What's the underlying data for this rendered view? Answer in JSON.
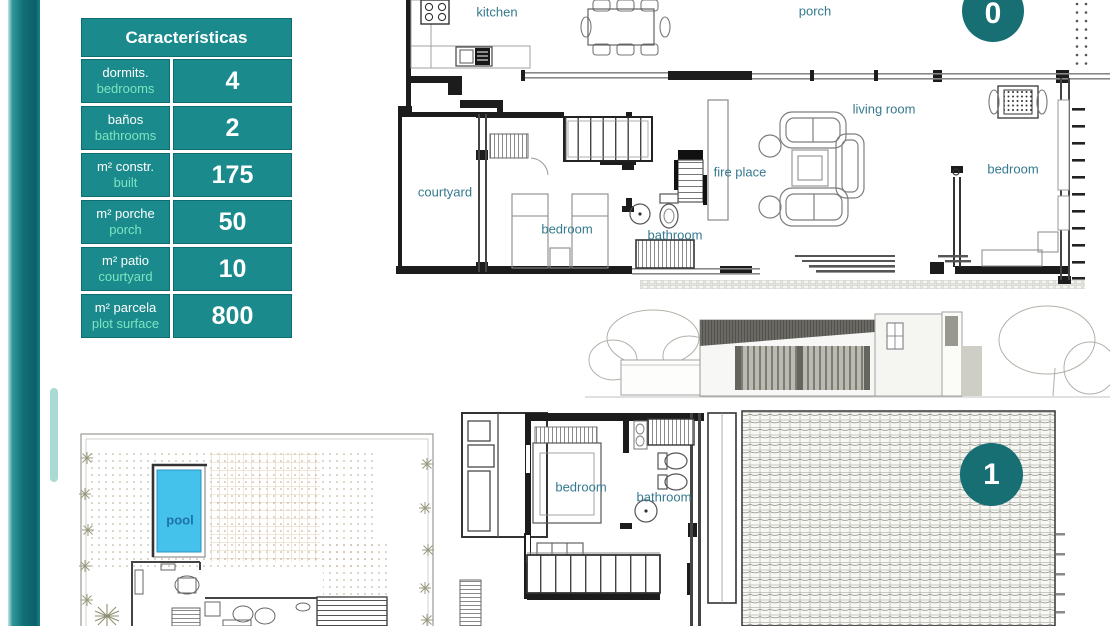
{
  "table": {
    "title": "Características",
    "rows": [
      {
        "label_es": "dormits.",
        "label_en": "bedrooms",
        "value": "4"
      },
      {
        "label_es": "baños",
        "label_en": "bathrooms",
        "value": "2"
      },
      {
        "label_es": "m² constr.",
        "label_en": "built",
        "value": "175"
      },
      {
        "label_es": "m² porche",
        "label_en": "porch",
        "value": "50"
      },
      {
        "label_es": "m² patio",
        "label_en": "courtyard",
        "value": "10"
      },
      {
        "label_es": "m² parcela",
        "label_en": "plot surface",
        "value": "800"
      }
    ]
  },
  "floor0": {
    "badge": "0",
    "labels": {
      "kitchen": "kitchen",
      "porch": "porch",
      "living_room": "living room",
      "fire_place": "fire place",
      "bedroom_right": "bedroom",
      "courtyard": "courtyard",
      "bedroom_center": "bedroom",
      "bathroom": "bathroom"
    }
  },
  "floor1": {
    "badge": "1",
    "labels": {
      "bedroom": "bedroom",
      "bathroom": "bathroom"
    }
  },
  "site_plan": {
    "labels": {
      "pool": "pool"
    }
  },
  "colors": {
    "table_teal": "#1b8a8d",
    "badge_teal": "#176f74",
    "accent_green": "#7be6bf",
    "plan_label_blue": "#35798f",
    "pool_label_blue": "#1e72a8",
    "pool_water": "#45c2ec"
  }
}
